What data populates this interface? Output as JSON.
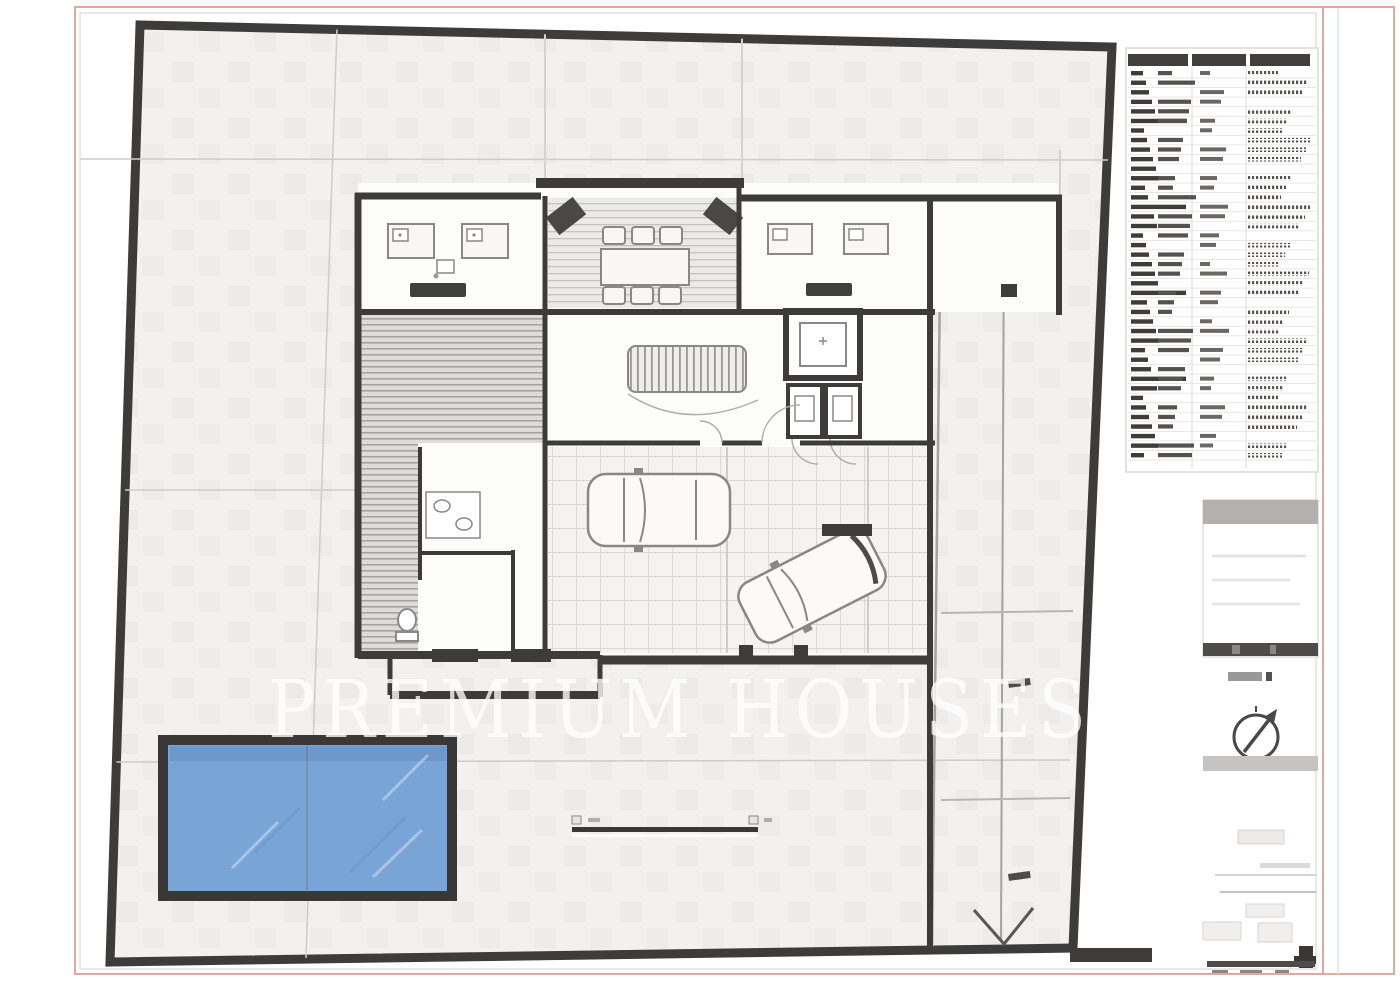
{
  "watermark": {
    "text": "PREMIUM HOUSES"
  },
  "colors": {
    "frame_pink": "#dcaaa1",
    "site_fill": "#f2f1ef",
    "wall": "#3e3c3a",
    "pool_water": "#79a5d6",
    "pool_border": "#3a3836",
    "watermark": "rgba(255,255,255,0.78)"
  },
  "legend": {
    "rows": 41
  }
}
